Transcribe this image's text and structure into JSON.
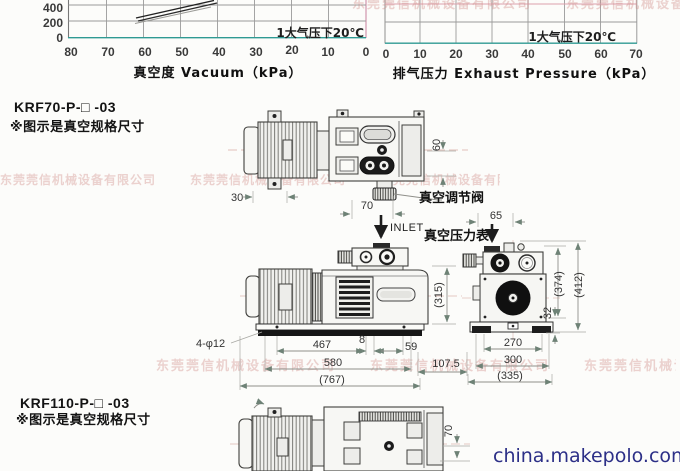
{
  "watermark": {
    "company": "东莞莞信机械设备有限公司",
    "site": "china.makepolo.com"
  },
  "charts": {
    "left": {
      "xlabel": "真空度 Vacuum（kPa）",
      "annotation": "1大气压下20℃",
      "x_ticks": [
        "80",
        "70",
        "60",
        "50",
        "40",
        "30",
        "20",
        "10",
        "0"
      ],
      "y_ticks": [
        "400",
        "200",
        "0"
      ]
    },
    "right": {
      "xlabel": "排气压力 Exhaust Pressure（kPa）",
      "annotation": "1大气压下20℃",
      "x_ticks": [
        "0",
        "10",
        "20",
        "30",
        "40",
        "50",
        "60",
        "70"
      ]
    }
  },
  "chart_data": [
    {
      "type": "line",
      "title": "",
      "xlabel": "真空度 Vacuum（kPa）",
      "x_ticks": [
        80,
        70,
        60,
        50,
        40,
        30,
        20,
        10,
        0
      ],
      "y_ticks_visible": [
        0,
        200,
        400
      ],
      "annotation": "1大气压下20℃",
      "series": [
        {
          "name": "curve-upper",
          "x": [
            61,
            48
          ],
          "y": [
            430,
            570
          ]
        },
        {
          "name": "curve-lower",
          "x": [
            61,
            48
          ],
          "y": [
            400,
            540
          ]
        }
      ],
      "note": "scan cropped at top; curves only partially visible rising above 400 between 60 and 48 kPa"
    },
    {
      "type": "line",
      "title": "",
      "xlabel": "排气压力 Exhaust Pressure（kPa）",
      "x_ticks": [
        0,
        10,
        20,
        30,
        40,
        50,
        60,
        70
      ],
      "annotation": "1大气压下20℃",
      "series": [],
      "note": "scan cropped at top; no curves visible in remaining strip"
    }
  ],
  "sections": {
    "krf70": {
      "model": "KRF70-P-□ -03",
      "note": "※图示是真空规格尺寸"
    },
    "krf110": {
      "model": "KRF110-P-□ -03",
      "note": "※图示是真空规格尺寸"
    }
  },
  "labels": {
    "vacuum_regulator": "真空调节阀",
    "inlet": "INLET",
    "vacuum_gauge": "真空压力表"
  },
  "dims": {
    "top_30": "30",
    "top_60": "60",
    "top_70": "70",
    "top_65": "65",
    "side_holes": "4-φ12",
    "side_467": "467",
    "side_8": "8",
    "side_59": "59",
    "side_580": "580",
    "side_107_5": "107.5",
    "side_767": "(767)",
    "side_315": "(315)",
    "end_270": "270",
    "end_300": "300",
    "end_335": "(335)",
    "end_374": "(374)",
    "end_412": "(412)",
    "end_32": "32",
    "bottom_70": "70"
  }
}
